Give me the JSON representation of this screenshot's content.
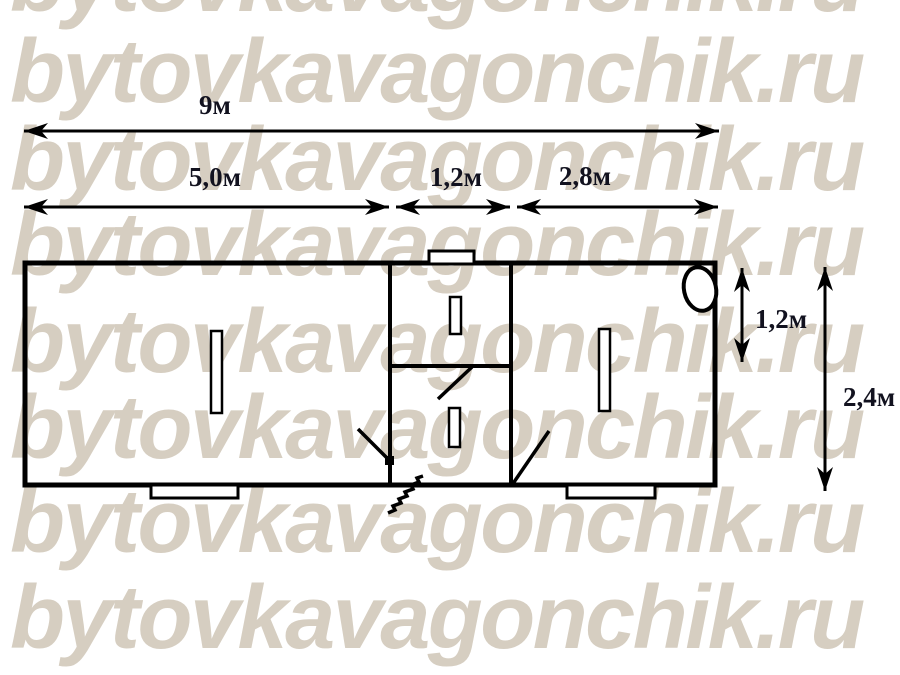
{
  "watermark": {
    "text": "bytovkavagonchik.ru",
    "color": "#d6cec1"
  },
  "plan": {
    "type": "floor-plan",
    "line_color": "#000000",
    "label_color": "#12121f",
    "dimensions": {
      "total_length": "9м",
      "left_room_length": "5,0м",
      "hall_length": "1,2м",
      "right_room_length": "2,8м",
      "hall_depth": "1,2м",
      "total_width": "2,4м"
    },
    "features": {
      "rooms": [
        "left room",
        "entry hall top",
        "entry hall bottom",
        "right room"
      ],
      "window_count": 4,
      "door_count": 3,
      "roof_vent": "top wall vent",
      "boiler": "oval fixture top-right corner",
      "steps": [
        "step under left room",
        "step under right room",
        "entrance steps hatch"
      ]
    }
  }
}
